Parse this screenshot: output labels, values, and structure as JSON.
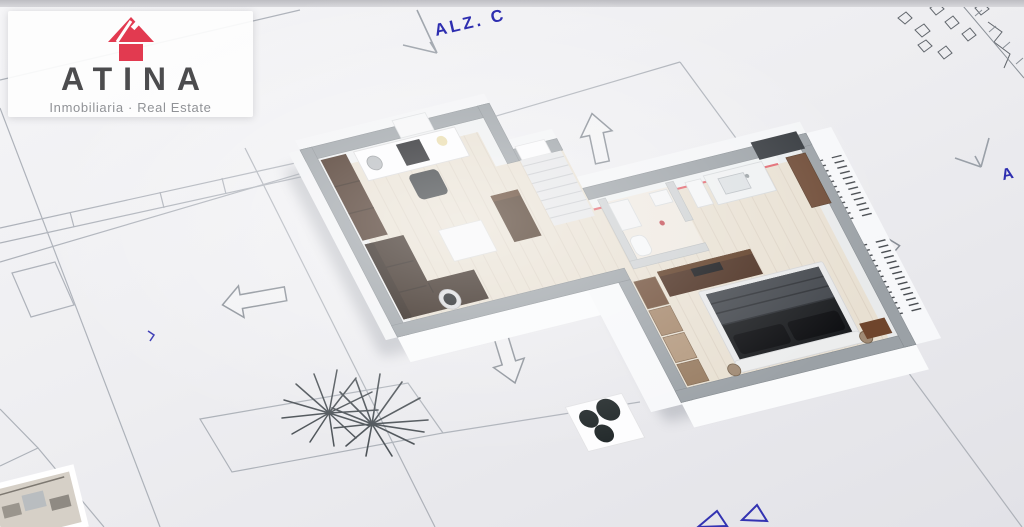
{
  "logo": {
    "brand": "ATINA",
    "tagline": "Inmobiliaria · Real Estate",
    "icon": "house-icon",
    "accent_color": "#e23a50",
    "text_color": "#4c4c4e",
    "tagline_color": "#909296"
  },
  "annotations": {
    "elevation_label": "ALZ. C",
    "right_edge_label": "A",
    "ink_color": "#2e2eb0"
  },
  "palette": {
    "paper": "#ededf0",
    "blueprint_line": "#a7acb4",
    "wall_top": "#9ba1a6",
    "wall_face": "#fafbfc",
    "floor_wood": "#e8e0d2",
    "sofa_brown": "#2b1d14",
    "bedding_dark": "#1b1d20",
    "wardrobe_tan": "#a5876b",
    "glass_rail_red": "#e2666e"
  }
}
